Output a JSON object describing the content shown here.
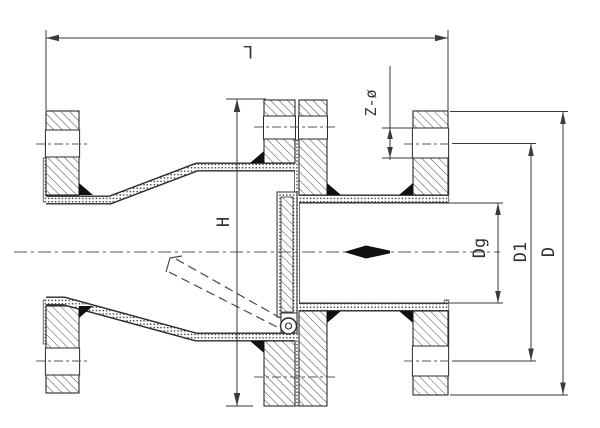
{
  "labels": {
    "length": "L",
    "height": "H",
    "bolt_holes": "Z-ø",
    "nominal_diameter": "Dg",
    "bolt_circle_diameter": "D1",
    "outside_diameter": "D"
  },
  "colors": {
    "background": "#ffffff",
    "line": "#2b2b2b",
    "dim": "#3a3a3a",
    "center": "#5a5a5a"
  }
}
